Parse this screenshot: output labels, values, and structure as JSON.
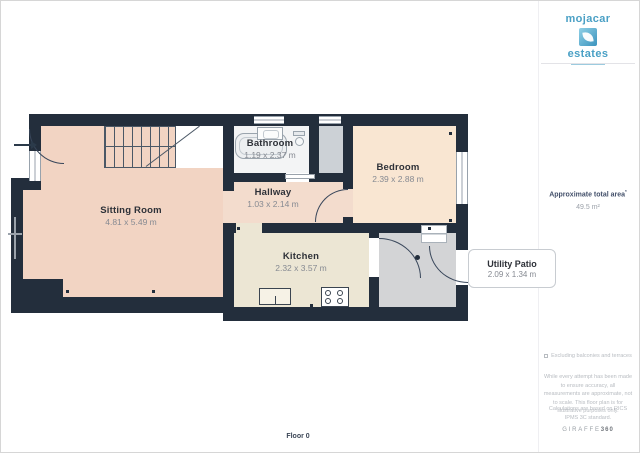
{
  "plan": {
    "floor_label": "Floor 0",
    "rooms": [
      {
        "name": "Sitting Room",
        "dims": "4.81 x 5.49 m"
      },
      {
        "name": "Bathroom",
        "dims": "1.19 x 2.37 m"
      },
      {
        "name": "Hallway",
        "dims": "1.03 x 2.14 m"
      },
      {
        "name": "Bedroom",
        "dims": "2.39 x 2.88 m"
      },
      {
        "name": "Kitchen",
        "dims": "2.32 x 3.57 m"
      },
      {
        "name": "Utility Patio",
        "dims": "2.09 x 1.34 m"
      }
    ]
  },
  "branding": {
    "agency_name_top": "mojacar",
    "agency_name_bottom": "estates",
    "logo_mark_icon": "leaf-icon"
  },
  "sidebar": {
    "area_title": "Approximate total area",
    "area_note_marker": "*",
    "area_value": "49.5 m²",
    "excluding_note": "Excluding balconies and terraces",
    "disclaimer": "While every attempt has been made to ensure accuracy, all measurements are approximate, not to scale. This floor plan is for illustrative purposes only.",
    "standard_note": "Calculations are based on RICS IPMS 3C standard.",
    "watermark_brand": "GIRAFFE",
    "watermark_suffix": "360"
  },
  "colors": {
    "wall": "#232e3c",
    "sitting_room_fill": "#f2d4c3",
    "hallway_fill": "#f3dccd",
    "bedroom_fill": "#f9e6d2",
    "kitchen_fill": "#ece6d4",
    "bathroom_fill": "#f3f4f5",
    "closet_fill": "#ccd1d6",
    "patio_fill": "#d3d4d6",
    "brand_blue": "#4aa0c5"
  }
}
